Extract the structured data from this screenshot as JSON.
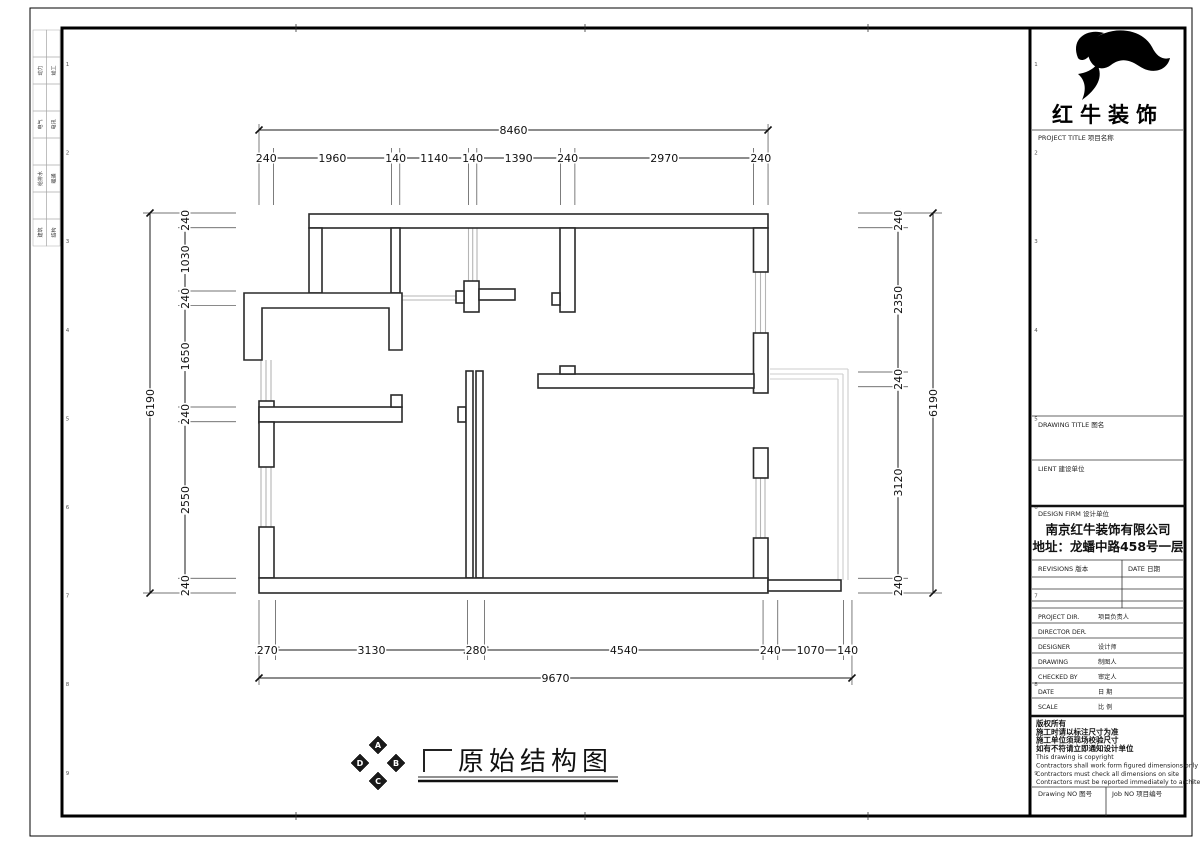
{
  "sheet": {
    "drawing_title": "原始结构图",
    "stamp_letters": [
      "A",
      "B",
      "C",
      "D"
    ],
    "zone_numbers": [
      "1",
      "2",
      "3",
      "4",
      "5",
      "6",
      "7",
      "8",
      "9"
    ],
    "margin_disciplines": [
      [
        "动力",
        "竣工"
      ],
      [
        "电气",
        "电讯"
      ],
      [
        "给排水",
        "暖通"
      ],
      [
        "建筑",
        "结构"
      ]
    ]
  },
  "dimensions": {
    "top": {
      "total": 8460,
      "segments": [
        240,
        1960,
        140,
        1140,
        140,
        1390,
        240,
        2970,
        240
      ]
    },
    "bottom": {
      "total": 9670,
      "segments": [
        270,
        3130,
        280,
        4540,
        240,
        1070,
        140
      ]
    },
    "left": {
      "total": 6190,
      "segments": [
        240,
        1030,
        240,
        1650,
        240,
        2550,
        240
      ]
    },
    "right": {
      "total": 6190,
      "segments": [
        240,
        2350,
        240,
        3120,
        240
      ]
    }
  },
  "title_block": {
    "brand": "红牛装饰",
    "project_title_label": "PROJECT TITLE  项目名称",
    "drawing_title_label": "DRAWING TITLE  图名",
    "client_label": "LIENT  建设单位",
    "design_firm_label": "DESIGN FIRM  设计单位",
    "company": "南京红牛装饰有限公司",
    "address": "地址：龙蟠中路458号一层",
    "revisions_label": "REVISIONS  版本",
    "date_col_label": "DATE  日期",
    "personnel_rows": [
      [
        "PROJECT DIR.",
        "项目负责人"
      ],
      [
        "DIRECTOR DER.",
        ""
      ],
      [
        "DESIGNER",
        "设计师"
      ],
      [
        "DRAWING",
        "制图人"
      ],
      [
        "CHECKED BY",
        "审定人"
      ],
      [
        "DATE",
        "日  期"
      ],
      [
        "SCALE",
        "比  例"
      ]
    ],
    "copyright_lines": [
      "版权所有",
      "施工时请以标注尺寸为准",
      "施工单位须现场校验尺寸",
      "如有不符请立即通知设计单位",
      "This drawing is copyright",
      "Contractors shall work form figured dimensions only",
      "Contractors must check all dimensions on site",
      "Contractors must be reported immediately to architects"
    ],
    "drawing_no_label": "Drawing NO  图号",
    "job_no_label": "Job NO  项目编号"
  },
  "colors": {
    "line": "#2a2a2a",
    "window": "#b5b5b5",
    "balcony": "#cccccc"
  }
}
